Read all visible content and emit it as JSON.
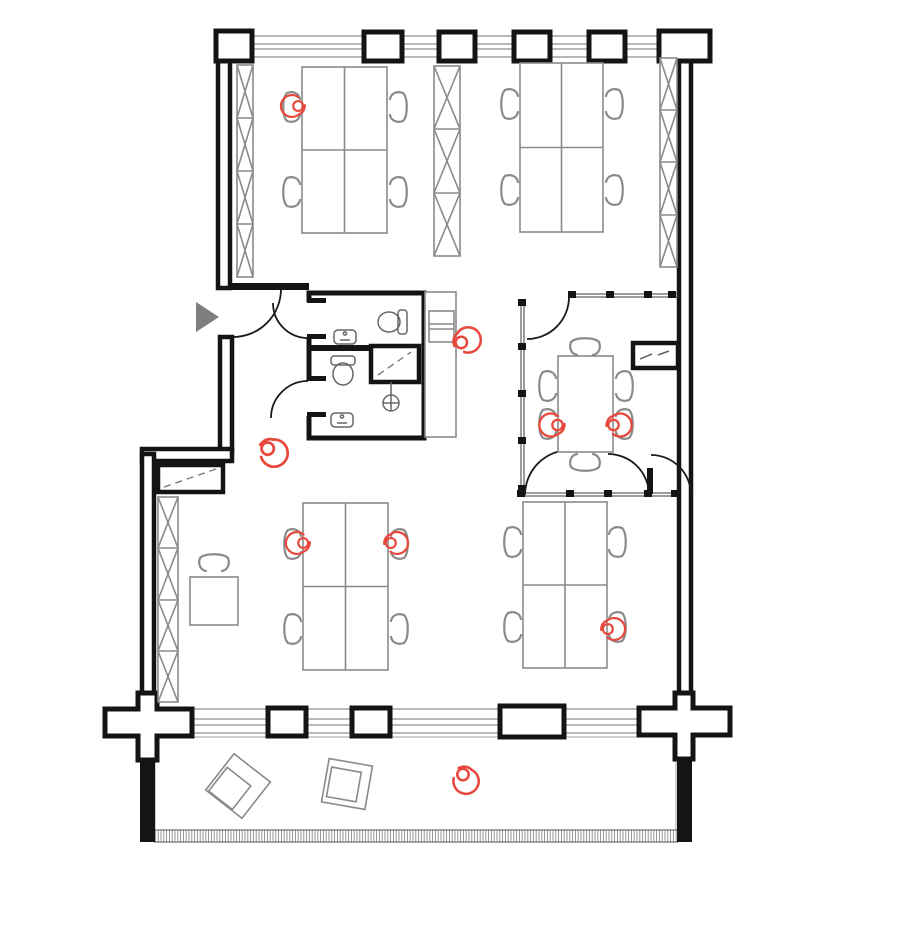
{
  "document": {
    "type": "architectural-floor-plan",
    "view": "top-down office plan with terrace",
    "visible_text": "none"
  },
  "palette": {
    "background": "#ffffff",
    "wall": "#141414",
    "furniture_outline": "#8a8a8a",
    "fixture_outline": "#777777",
    "glass_partition": "#3a3a3a",
    "window_band": "#8f8f8f",
    "deck_hatch": "#adadad",
    "occupant_red": "#e8483c",
    "entry_arrow_gray": "#7e7e7e"
  },
  "architecture": {
    "zones": [
      {
        "name": "open-office-north",
        "contents": "2 quad desk clusters, 3 x-braced shelving units"
      },
      {
        "name": "entry-corridor-west",
        "contents": "entrance door with direction arrow"
      },
      {
        "name": "sanitary-block",
        "contents": "2 WC rooms with toilets and sinks, shower closet, floor drain"
      },
      {
        "name": "kitchenette-strip",
        "contents": "counter with appliance"
      },
      {
        "name": "meeting-room",
        "contents": "conference table with 6 chairs, glazed partitions, wall niche"
      },
      {
        "name": "open-office-south",
        "contents": "2 quad desk clusters, single desk, x-braced shelving unit, wall niche cabinet"
      },
      {
        "name": "terrace-south",
        "contents": "decking, 2 rotated lounge tables, railing"
      }
    ],
    "column_count_north_wall": 6,
    "column_count_south_wall": 5
  },
  "furniture_summary": {
    "quad_desk_clusters": 4,
    "single_desks": 1,
    "conference_tables": 1,
    "task_chairs": 23,
    "shelving_units": 4,
    "terrace_tables": 2
  },
  "occupants": [
    {
      "id": "occupant-1",
      "location": "north-west cluster, upper-left seat",
      "posture": "seated",
      "transform": "translate(292,106) scale(0.95)"
    },
    {
      "id": "occupant-2",
      "location": "kitchenette counter",
      "posture": "standing",
      "transform": "translate(468,340) rotate(160) scale(1.1)"
    },
    {
      "id": "occupant-3",
      "location": "meeting table, left seat",
      "posture": "seated",
      "transform": "translate(551,425)"
    },
    {
      "id": "occupant-4",
      "location": "meeting table, right seat",
      "posture": "seated",
      "transform": "translate(620,425) rotate(180)"
    },
    {
      "id": "occupant-5",
      "location": "central circulation area",
      "posture": "walking",
      "transform": "translate(274,453) rotate(215) scale(1.18)"
    },
    {
      "id": "occupant-6",
      "location": "south-west cluster, upper-left seat",
      "posture": "seated",
      "transform": "translate(297,543) scale(0.95)"
    },
    {
      "id": "occupant-7",
      "location": "south-west cluster, upper-right seat",
      "posture": "seated",
      "transform": "translate(397,543) rotate(180) scale(0.95)"
    },
    {
      "id": "occupant-8",
      "location": "south-east cluster, lower-right seat",
      "posture": "seated",
      "transform": "translate(614,629) rotate(180) scale(0.95)"
    },
    {
      "id": "occupant-9",
      "location": "terrace",
      "posture": "walking",
      "transform": "translate(466,781) rotate(245) scale(1.1)"
    }
  ],
  "entry": {
    "symbol": "gray triangle arrow pointing right",
    "side": "west wall"
  }
}
